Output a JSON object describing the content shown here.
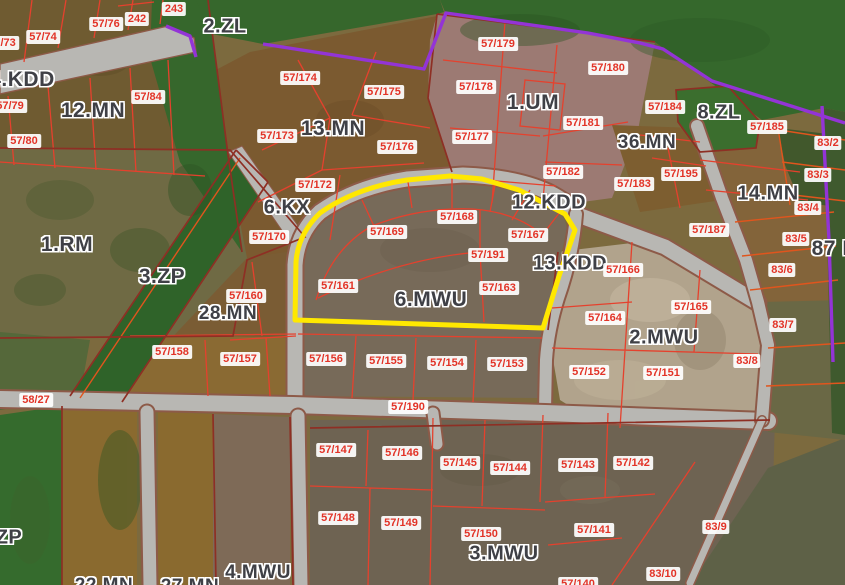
{
  "map": {
    "type": "cadastral-zoning-satellite-map",
    "colors": {
      "highlight_outline": "#ffe800",
      "parcel_line": "#e5412d",
      "administrative_boundary": "#9334d6",
      "road_fill": "#b8b7b3",
      "parcel_label_text": "#e23327",
      "parcel_label_bg": "#ffffff",
      "zone_label_text": "#3f4046"
    },
    "highlighted_zone": "6.MWU",
    "zone_labels": [
      {
        "text": "2.ZL",
        "x": 225,
        "y": 27,
        "size": 20
      },
      {
        "text": "4.KDD",
        "x": 22,
        "y": 80,
        "size": 21
      },
      {
        "text": "12.MN",
        "x": 93,
        "y": 111,
        "size": 21
      },
      {
        "text": "13.MN",
        "x": 333,
        "y": 129,
        "size": 21
      },
      {
        "text": "1.UM",
        "x": 533,
        "y": 103,
        "size": 21
      },
      {
        "text": "36.MN",
        "x": 647,
        "y": 143,
        "size": 19
      },
      {
        "text": "8.ZL",
        "x": 719,
        "y": 113,
        "size": 20
      },
      {
        "text": "14.MN",
        "x": 768,
        "y": 194,
        "size": 20
      },
      {
        "text": "87 M",
        "x": 836,
        "y": 249,
        "size": 21
      },
      {
        "text": "1.RM",
        "x": 67,
        "y": 245,
        "size": 21
      },
      {
        "text": "3.ZP",
        "x": 162,
        "y": 277,
        "size": 21
      },
      {
        "text": "6.KX",
        "x": 287,
        "y": 208,
        "size": 20
      },
      {
        "text": "28.MN",
        "x": 228,
        "y": 314,
        "size": 19
      },
      {
        "text": "12.KDD",
        "x": 549,
        "y": 203,
        "size": 20
      },
      {
        "text": "13.KDD",
        "x": 570,
        "y": 264,
        "size": 20
      },
      {
        "text": "6.MWU",
        "x": 431,
        "y": 300,
        "size": 21
      },
      {
        "text": "2.MWU",
        "x": 664,
        "y": 338,
        "size": 20
      },
      {
        "text": "3.MWU",
        "x": 504,
        "y": 554,
        "size": 20
      },
      {
        "text": "4.MWU",
        "x": 258,
        "y": 573,
        "size": 19
      },
      {
        "text": "ZP",
        "x": 9,
        "y": 538,
        "size": 20
      },
      {
        "text": "22.MN",
        "x": 104,
        "y": 586,
        "size": 19
      },
      {
        "text": "27.MN",
        "x": 190,
        "y": 587,
        "size": 19
      }
    ],
    "parcel_labels": [
      {
        "text": "57/73",
        "x": 2,
        "y": 43
      },
      {
        "text": "57/74",
        "x": 43,
        "y": 37
      },
      {
        "text": "57/76",
        "x": 106,
        "y": 24
      },
      {
        "text": "242",
        "x": 137,
        "y": 19
      },
      {
        "text": "243",
        "x": 174,
        "y": 9
      },
      {
        "text": "57/84",
        "x": 148,
        "y": 97
      },
      {
        "text": "57/79",
        "x": 10,
        "y": 106
      },
      {
        "text": "57/80",
        "x": 24,
        "y": 141
      },
      {
        "text": "57/174",
        "x": 300,
        "y": 78
      },
      {
        "text": "57/175",
        "x": 384,
        "y": 92
      },
      {
        "text": "57/173",
        "x": 277,
        "y": 136
      },
      {
        "text": "57/176",
        "x": 397,
        "y": 147
      },
      {
        "text": "57/172",
        "x": 315,
        "y": 185
      },
      {
        "text": "57/170",
        "x": 269,
        "y": 237
      },
      {
        "text": "57/160",
        "x": 246,
        "y": 296
      },
      {
        "text": "57/158",
        "x": 172,
        "y": 352
      },
      {
        "text": "57/157",
        "x": 240,
        "y": 359
      },
      {
        "text": "58/27",
        "x": 36,
        "y": 400
      },
      {
        "text": "57/179",
        "x": 498,
        "y": 44
      },
      {
        "text": "57/180",
        "x": 608,
        "y": 68
      },
      {
        "text": "57/178",
        "x": 476,
        "y": 87
      },
      {
        "text": "57/181",
        "x": 583,
        "y": 123
      },
      {
        "text": "57/177",
        "x": 472,
        "y": 137
      },
      {
        "text": "57/182",
        "x": 563,
        "y": 172
      },
      {
        "text": "57/183",
        "x": 634,
        "y": 184
      },
      {
        "text": "57/184",
        "x": 665,
        "y": 107
      },
      {
        "text": "57/185",
        "x": 767,
        "y": 127
      },
      {
        "text": "57/195",
        "x": 681,
        "y": 174
      },
      {
        "text": "83/2",
        "x": 828,
        "y": 143
      },
      {
        "text": "83/3",
        "x": 818,
        "y": 175
      },
      {
        "text": "83/4",
        "x": 808,
        "y": 208
      },
      {
        "text": "83/5",
        "x": 796,
        "y": 239
      },
      {
        "text": "83/6",
        "x": 782,
        "y": 270
      },
      {
        "text": "57/187",
        "x": 709,
        "y": 230
      },
      {
        "text": "57/168",
        "x": 457,
        "y": 217
      },
      {
        "text": "57/169",
        "x": 387,
        "y": 232
      },
      {
        "text": "57/167",
        "x": 528,
        "y": 235
      },
      {
        "text": "57/191",
        "x": 488,
        "y": 255
      },
      {
        "text": "57/161",
        "x": 338,
        "y": 286
      },
      {
        "text": "57/163",
        "x": 499,
        "y": 288
      },
      {
        "text": "57/166",
        "x": 623,
        "y": 270
      },
      {
        "text": "57/164",
        "x": 605,
        "y": 318
      },
      {
        "text": "57/165",
        "x": 691,
        "y": 307
      },
      {
        "text": "83/7",
        "x": 783,
        "y": 325
      },
      {
        "text": "57/152",
        "x": 589,
        "y": 372
      },
      {
        "text": "57/151",
        "x": 663,
        "y": 373
      },
      {
        "text": "83/8",
        "x": 747,
        "y": 361
      },
      {
        "text": "57/156",
        "x": 326,
        "y": 359
      },
      {
        "text": "57/155",
        "x": 386,
        "y": 361
      },
      {
        "text": "57/154",
        "x": 447,
        "y": 363
      },
      {
        "text": "57/153",
        "x": 507,
        "y": 364
      },
      {
        "text": "57/190",
        "x": 408,
        "y": 407
      },
      {
        "text": "57/147",
        "x": 336,
        "y": 450
      },
      {
        "text": "57/146",
        "x": 402,
        "y": 453
      },
      {
        "text": "57/145",
        "x": 460,
        "y": 463
      },
      {
        "text": "57/144",
        "x": 510,
        "y": 468
      },
      {
        "text": "57/143",
        "x": 578,
        "y": 465
      },
      {
        "text": "57/142",
        "x": 633,
        "y": 463
      },
      {
        "text": "57/148",
        "x": 338,
        "y": 518
      },
      {
        "text": "57/149",
        "x": 401,
        "y": 523
      },
      {
        "text": "57/150",
        "x": 481,
        "y": 534
      },
      {
        "text": "57/141",
        "x": 594,
        "y": 530
      },
      {
        "text": "83/9",
        "x": 716,
        "y": 527
      },
      {
        "text": "83/10",
        "x": 663,
        "y": 574
      },
      {
        "text": "57/140",
        "x": 578,
        "y": 584
      }
    ]
  }
}
